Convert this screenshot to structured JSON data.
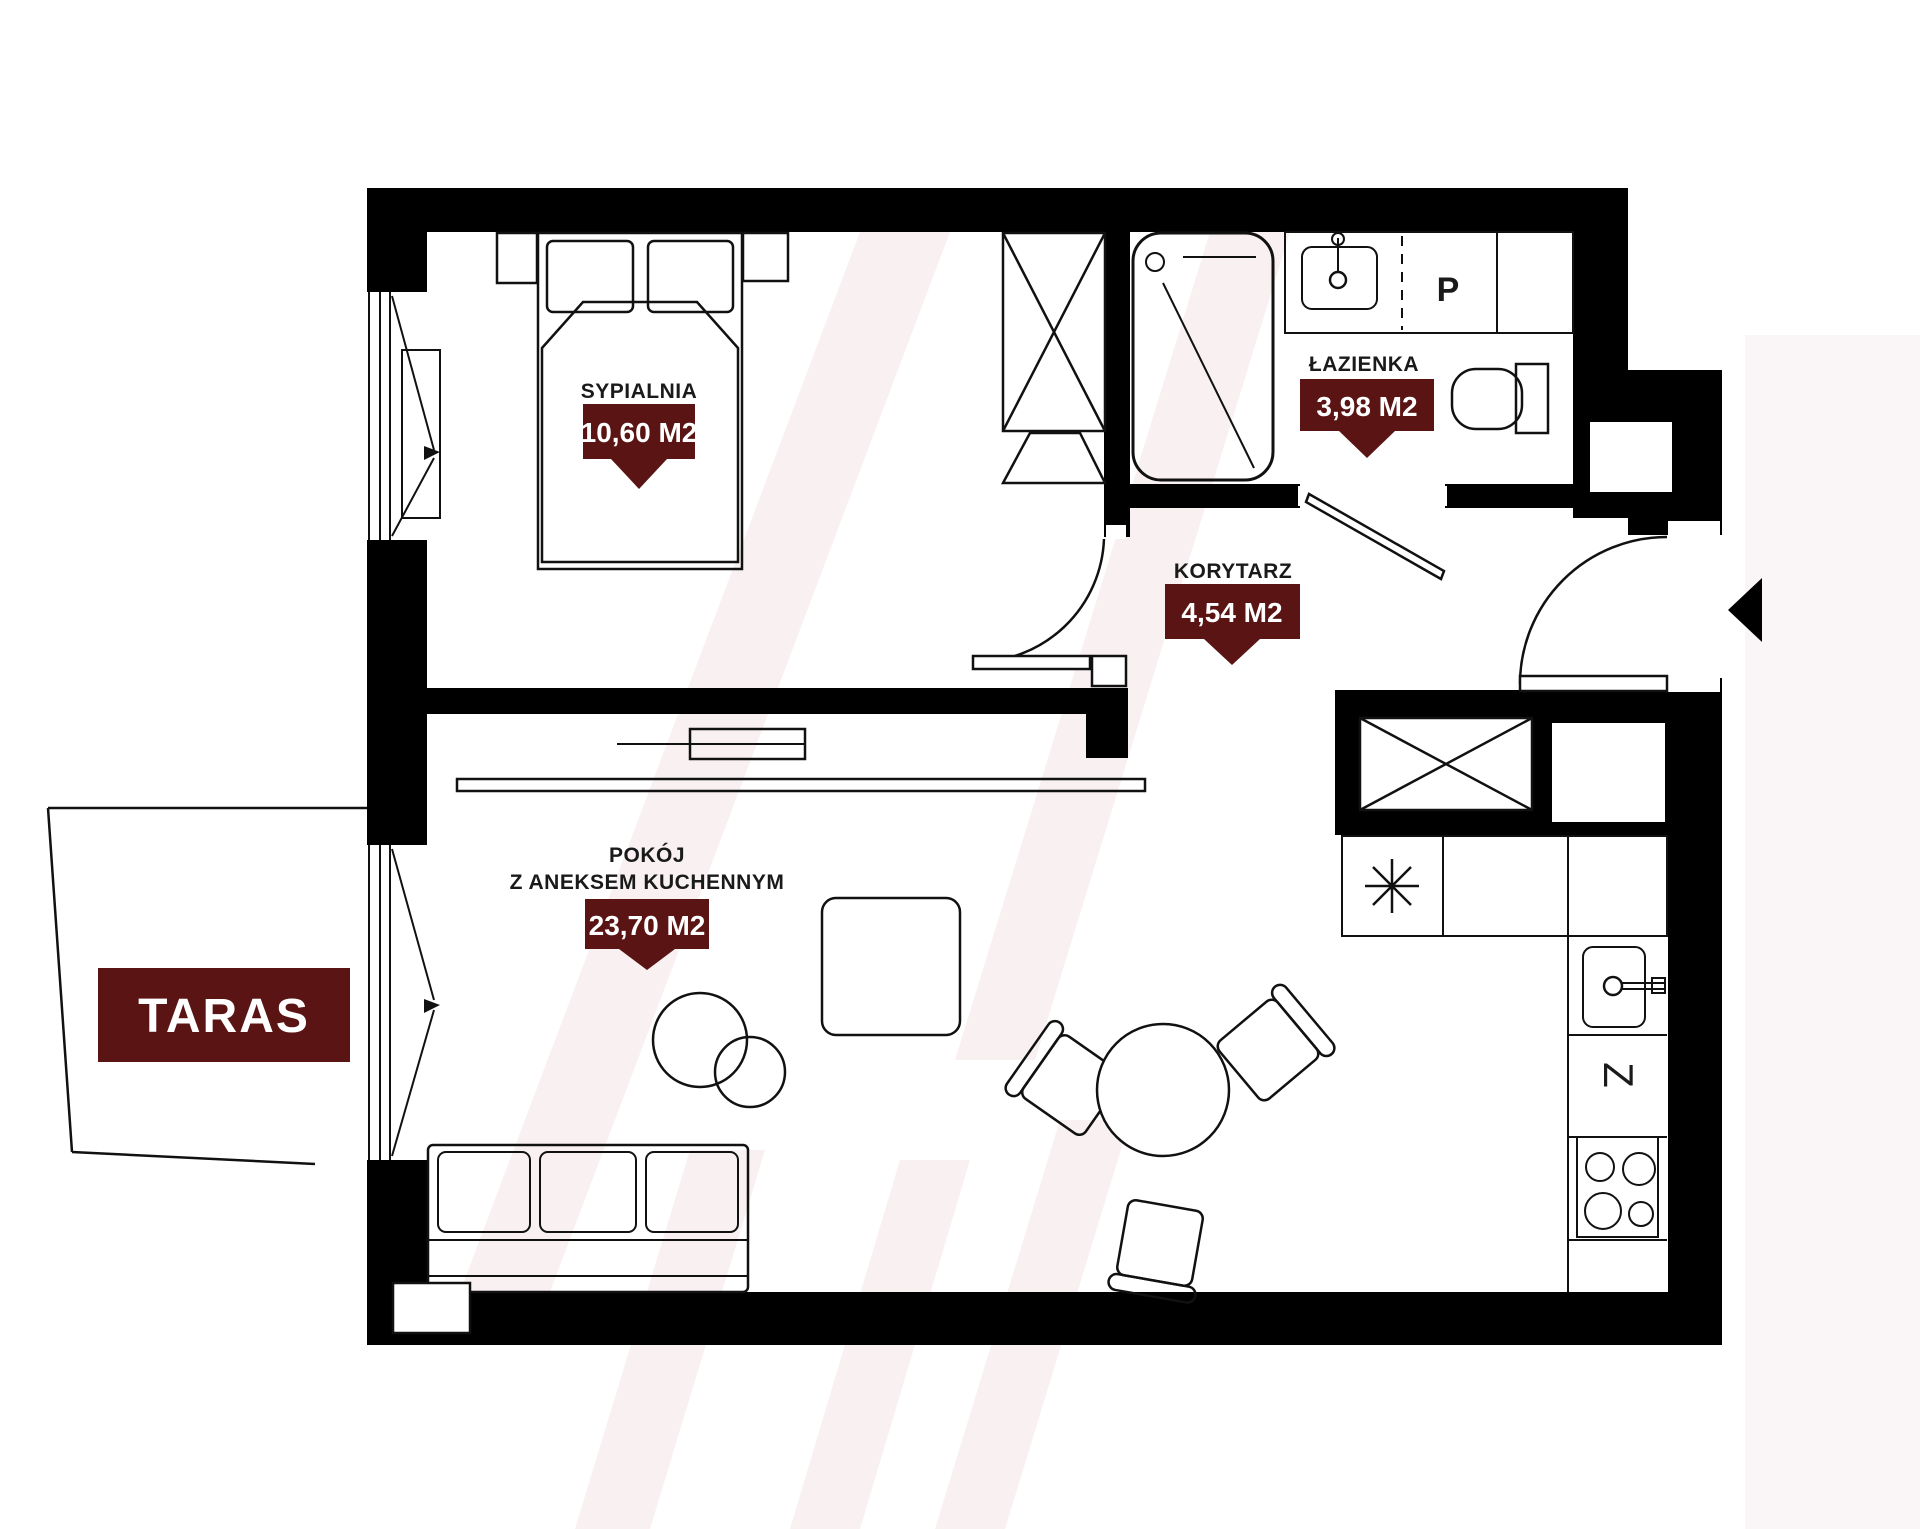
{
  "plan": {
    "rooms": [
      {
        "id": "sypialnia",
        "name": "SYPIALNIA",
        "area": "10,60 M2"
      },
      {
        "id": "lazienka",
        "name": "ŁAZIENKA",
        "area": "3,98 M2"
      },
      {
        "id": "korytarz",
        "name": "KORYTARZ",
        "area": "4,54 M2"
      },
      {
        "id": "pokoj",
        "name_line1": "POKÓJ",
        "name_line2": "Z ANEKSEM KUCHENNYM",
        "area": "23,70 M2"
      }
    ],
    "terrace": {
      "label": "TARAS"
    },
    "appliances": {
      "washer": "P",
      "fridge": "Z"
    },
    "colors": {
      "wall": "#000000",
      "line": "#111111",
      "badge": "#5a1413",
      "badge_text": "#ffffff",
      "watermark": "#f8f0f1",
      "background": "#ffffff"
    }
  }
}
